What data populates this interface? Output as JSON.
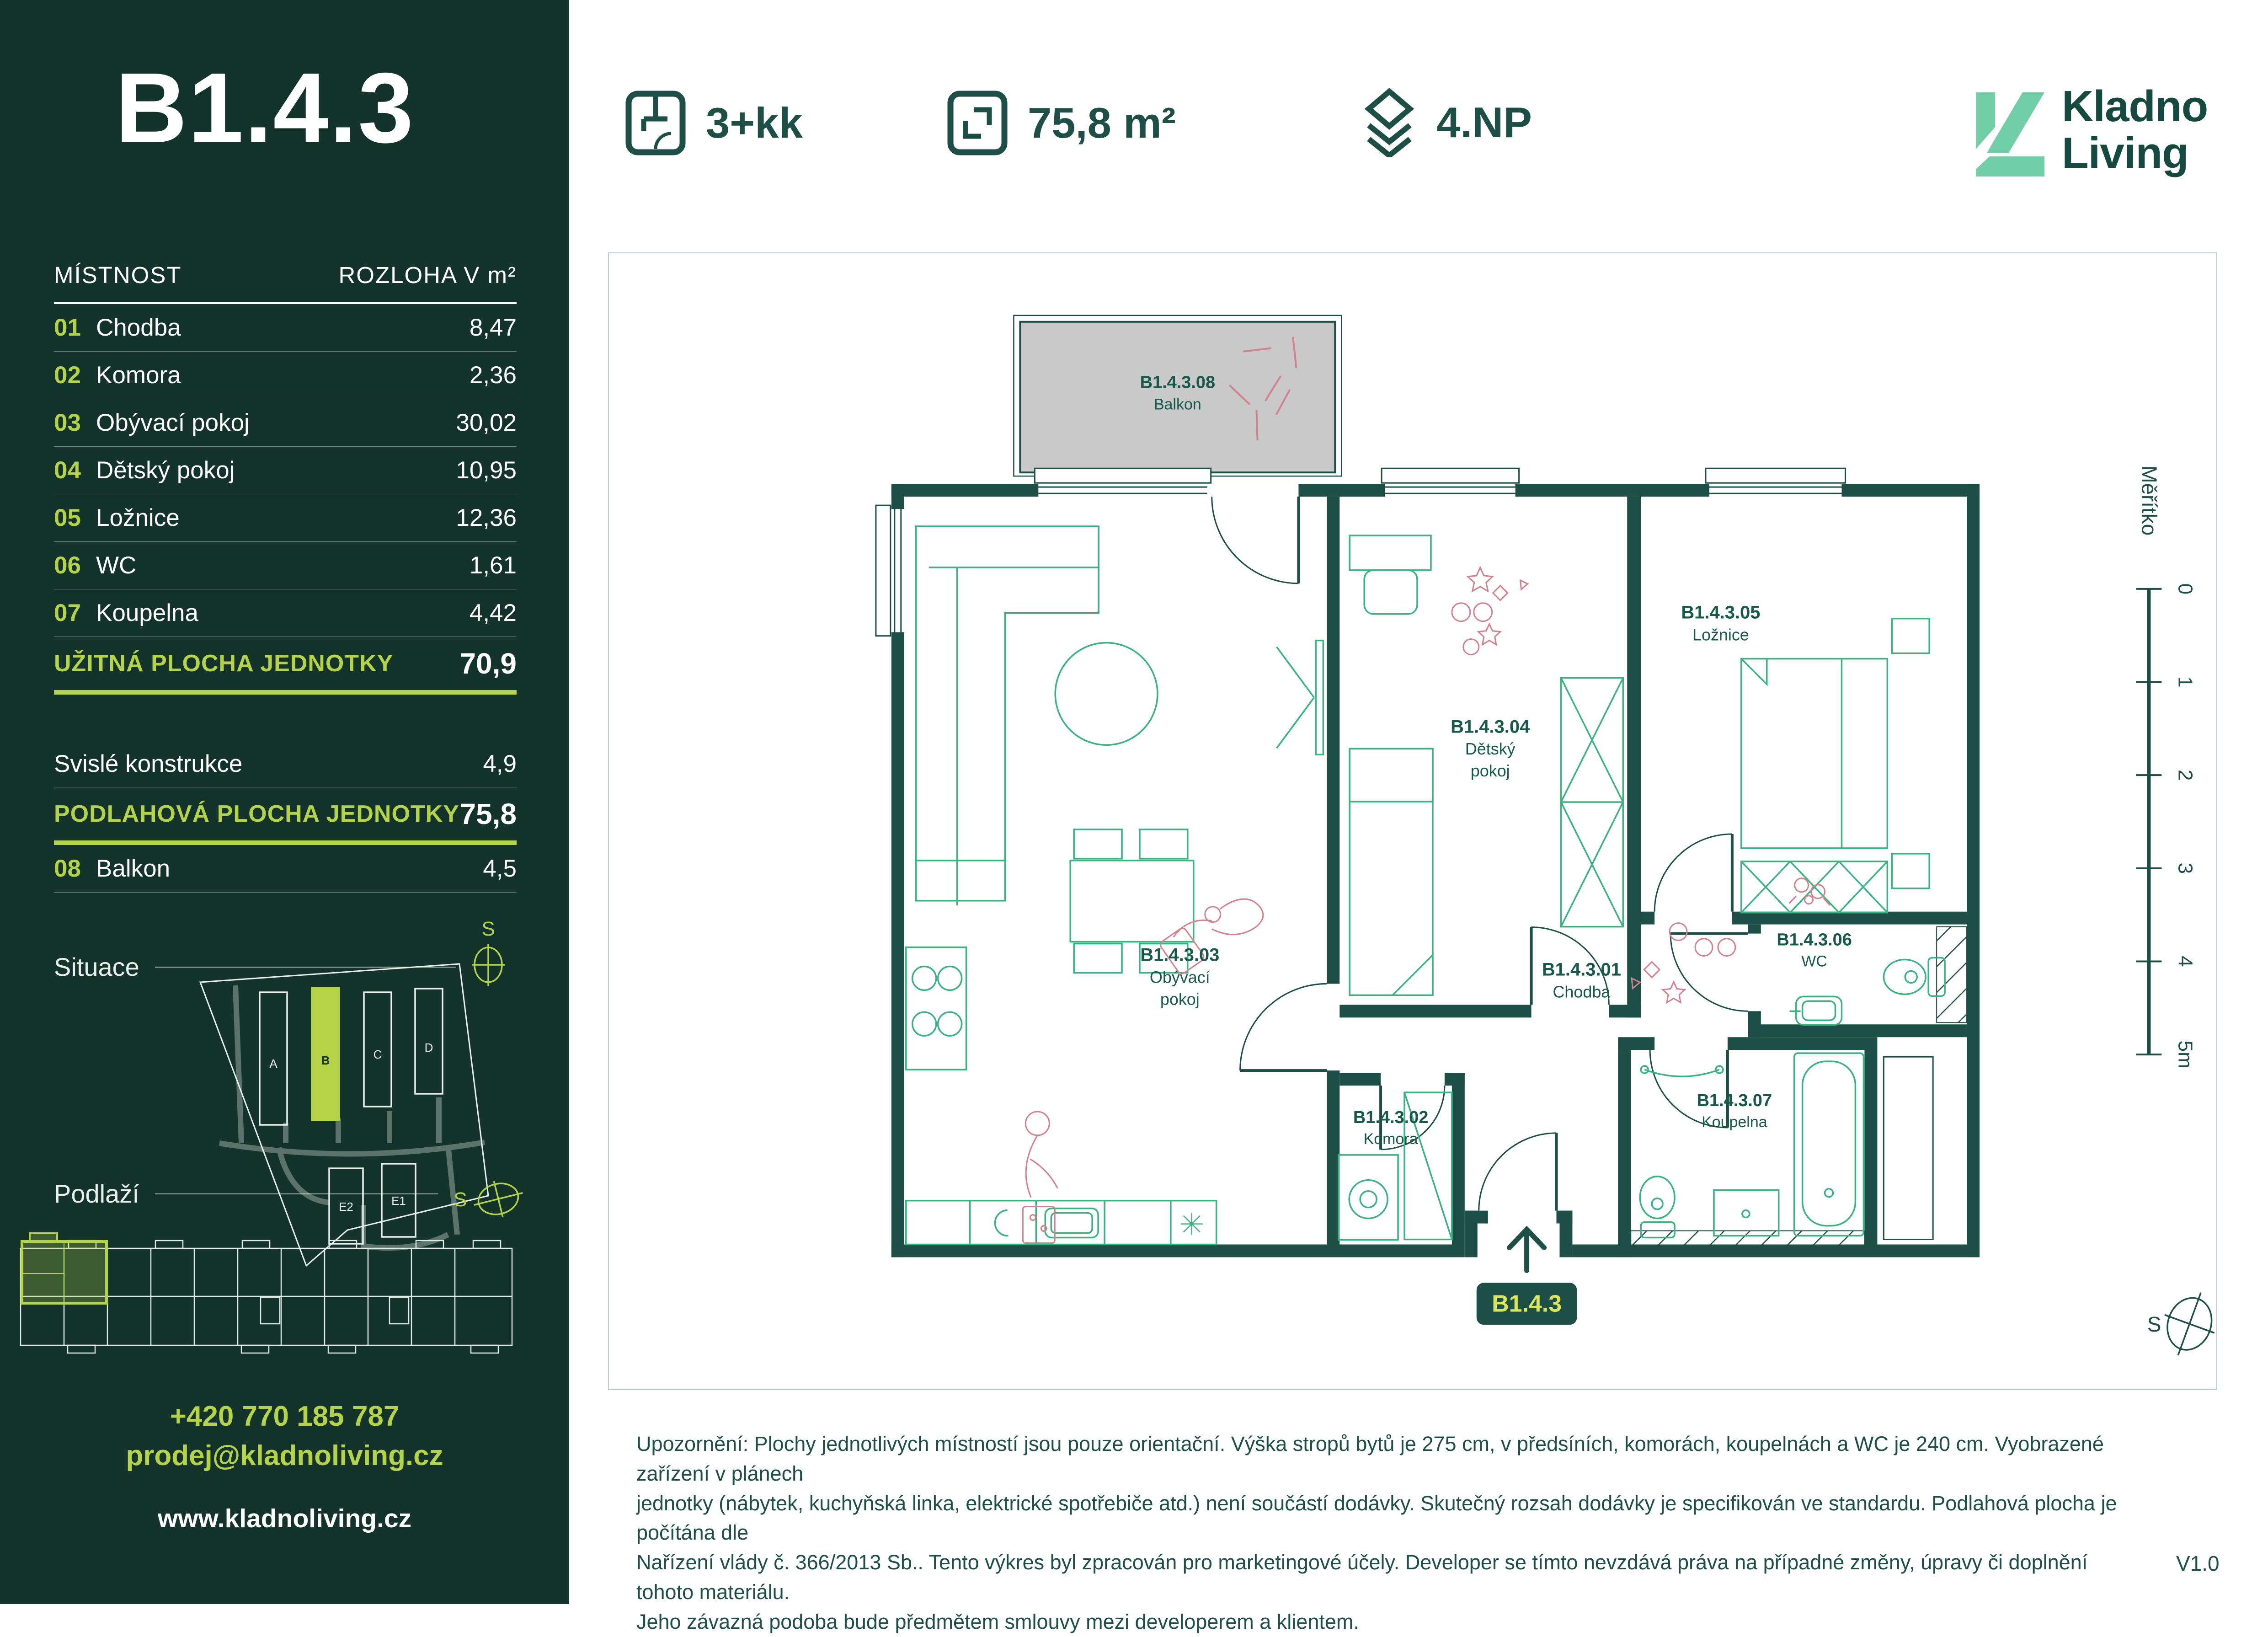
{
  "colors": {
    "sidebar_bg": "#14332b",
    "accent_lime": "#b4d348",
    "badge_text": "#d9e45f",
    "dark_teal": "#1d4f46",
    "label_teal": "#17594b",
    "furniture_green": "#39b481",
    "decor_pink": "#d5808d",
    "balcony_gray": "#c9c9c9",
    "logo_mint": "#72cfa5"
  },
  "sidebar": {
    "unit_title": "B1.4.3",
    "table": {
      "header_room": "MÍSTNOST",
      "header_area": "ROZLOHA V m²",
      "rows": [
        {
          "num": "01",
          "name": "Chodba",
          "area": "8,47"
        },
        {
          "num": "02",
          "name": "Komora",
          "area": "2,36"
        },
        {
          "num": "03",
          "name": "Obývací pokoj",
          "area": "30,02"
        },
        {
          "num": "04",
          "name": "Dětský pokoj",
          "area": "10,95"
        },
        {
          "num": "05",
          "name": "Ložnice",
          "area": "12,36"
        },
        {
          "num": "06",
          "name": "WC",
          "area": "1,61"
        },
        {
          "num": "07",
          "name": "Koupelna",
          "area": "4,42"
        }
      ],
      "usable_label": "UŽITNÁ PLOCHA JEDNOTKY",
      "usable_value": "70,9",
      "vertical_label": "Svislé konstrukce",
      "vertical_value": "4,9",
      "floor_label": "PODLAHOVÁ PLOCHA JEDNOTKY",
      "floor_value": "75,8",
      "balcony_num": "08",
      "balcony_name": "Balkon",
      "balcony_area": "4,5"
    },
    "situace_label": "Situace",
    "podlazi_label": "Podlaží",
    "compass_letter": "S",
    "situace_buildings": [
      "A",
      "B",
      "C",
      "D",
      "E2",
      "E1"
    ],
    "contact_phone": "+420 770 185 787",
    "contact_email": "prodej@kladnoliving.cz",
    "contact_web": "www.kladnoliving.cz"
  },
  "header": {
    "disposition": "3+kk",
    "area": "75,8 m²",
    "floor": "4.NP",
    "logo_line1": "Kladno",
    "logo_line2": "Living"
  },
  "plan": {
    "rooms": {
      "balkon": {
        "code": "B1.4.3.08",
        "name": "Balkon"
      },
      "obyvaci": {
        "code": "B1.4.3.03",
        "line1": "Obývací",
        "line2": "pokoj"
      },
      "detsky": {
        "code": "B1.4.3.04",
        "line1": "Dětský",
        "line2": "pokoj"
      },
      "loznice": {
        "code": "B1.4.3.05",
        "name": "Ložnice"
      },
      "chodba": {
        "code": "B1.4.3.01",
        "name": "Chodba"
      },
      "komora": {
        "code": "B1.4.3.02",
        "name": "Komora"
      },
      "wc": {
        "code": "B1.4.3.06",
        "name": "WC"
      },
      "koupelna": {
        "code": "B1.4.3.07",
        "name": "Koupelna"
      }
    },
    "entrance_badge": "B1.4.3",
    "scale_label": "Měřítko",
    "scale_ticks": [
      "0",
      "1",
      "2",
      "3",
      "4",
      "5m"
    ],
    "compass_letter": "S"
  },
  "footer": {
    "disclaimer": [
      "Upozornění: Plochy jednotlivých místností jsou pouze orientační. Výška stropů bytů je 275 cm, v předsíních, komorách, koupelnách a WC je 240 cm. Vyobrazené zařízení v plánech",
      "jednotky (nábytek, kuchyňská linka, elektrické spotřebiče atd.) není součástí dodávky. Skutečný rozsah dodávky je specifikován ve standardu. Podlahová plocha je počítána dle",
      "Nařízení vlády č. 366/2013 Sb.. Tento výkres byl zpracován pro marketingové účely. Developer se tímto nevzdává práva na případné změny, úpravy či doplnění tohoto materiálu.",
      "Jeho závazná podoba bude předmětem smlouvy mezi developerem a klientem."
    ],
    "version": "V1.0"
  }
}
